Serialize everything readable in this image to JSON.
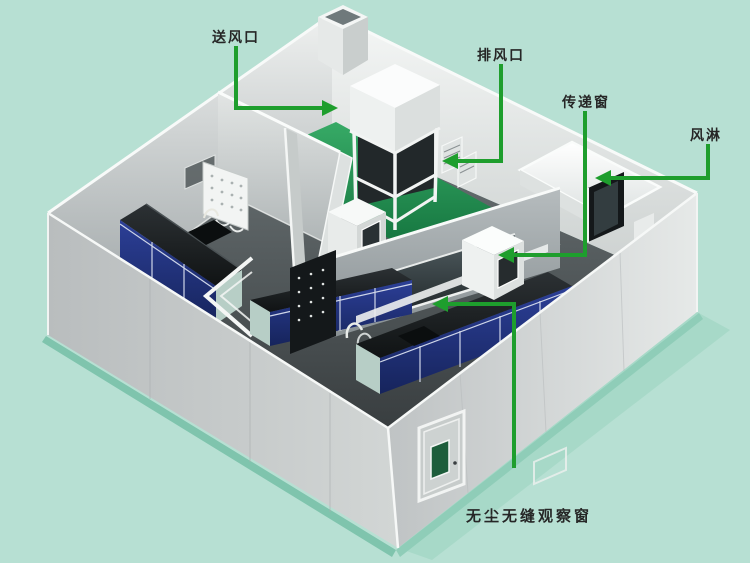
{
  "diagram": {
    "type": "cleanroom-lab-isometric-cutaway",
    "colors": {
      "background": "#b7e0d3",
      "callout_green": "#1e9e2d",
      "wall_gray": "#c9cecd",
      "floor_green": "#1e8a4b",
      "bench_black": "#17191c",
      "cabinet_blue": "#22307c",
      "door_window_green": "#1e5e3c"
    },
    "callouts": [
      {
        "id": "supply-air-vent",
        "label": "送风口",
        "target": "corridor-supply-air"
      },
      {
        "id": "exhaust-vent",
        "label": "排风口",
        "target": "wall-exhaust-louver"
      },
      {
        "id": "pass-through-window",
        "label": "传递窗",
        "target": "pass-box"
      },
      {
        "id": "air-shower",
        "label": "风淋",
        "target": "air-shower-room"
      },
      {
        "id": "observation-window",
        "label": "无尘无缝观察窗",
        "target": "seamless-observation-window"
      }
    ]
  }
}
